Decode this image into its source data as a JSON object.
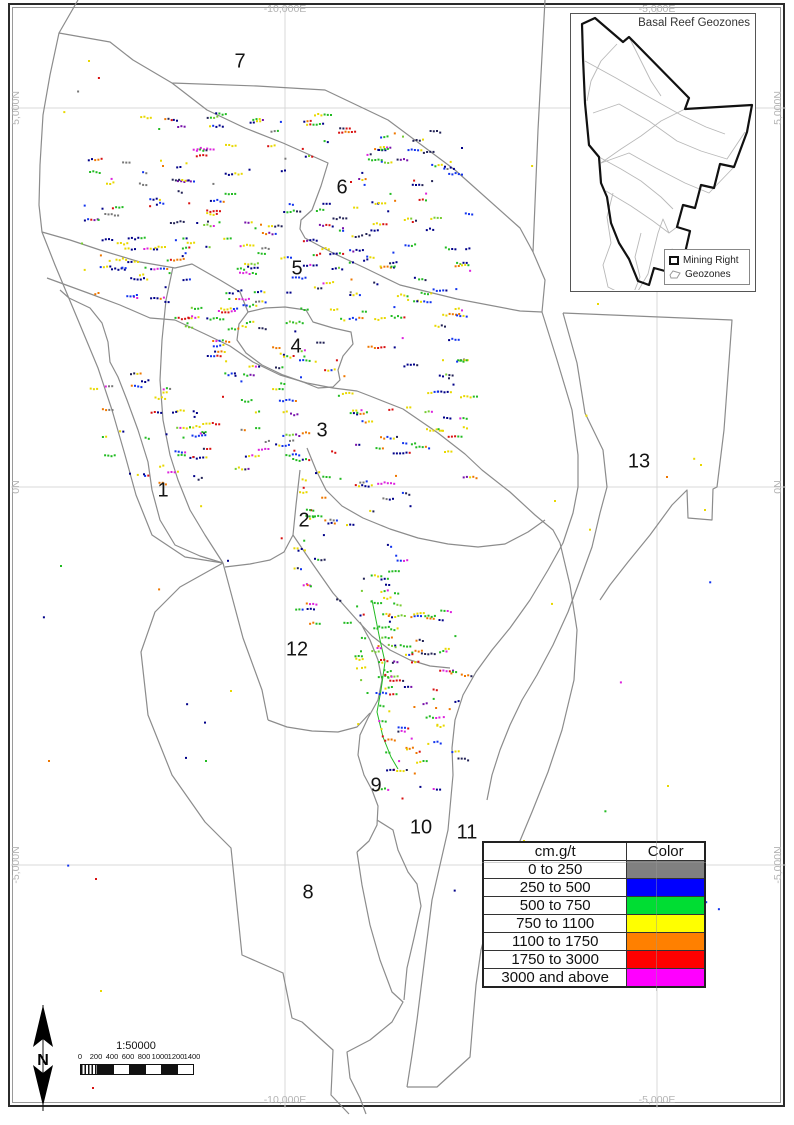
{
  "map": {
    "background": "#ffffff",
    "gridline_color": "#d9d9d9",
    "boundary_color": "#8c8c8c",
    "grid_labels": {
      "top": [
        {
          "text": "-10,000E",
          "x": 285
        },
        {
          "text": "-5,000E",
          "x": 657
        }
      ],
      "bottom": [
        {
          "text": "-10,000E",
          "x": 285
        },
        {
          "text": "-5,000E",
          "x": 657
        }
      ],
      "left": [
        {
          "text": "5,000N",
          "y": 108
        },
        {
          "text": "0N",
          "y": 487
        },
        {
          "text": "-5,000N",
          "y": 865
        }
      ],
      "right": [
        {
          "text": "5,000N",
          "y": 108
        },
        {
          "text": "0N",
          "y": 487
        },
        {
          "text": "-5,000N",
          "y": 865
        }
      ]
    },
    "grid_x": [
      285,
      657
    ],
    "grid_y": [
      108,
      487,
      865
    ],
    "zone_labels": [
      {
        "n": "1",
        "x": 163,
        "y": 491
      },
      {
        "n": "2",
        "x": 304,
        "y": 521
      },
      {
        "n": "3",
        "x": 322,
        "y": 431
      },
      {
        "n": "4",
        "x": 296,
        "y": 347
      },
      {
        "n": "5",
        "x": 297,
        "y": 269
      },
      {
        "n": "6",
        "x": 342,
        "y": 188
      },
      {
        "n": "7",
        "x": 240,
        "y": 62
      },
      {
        "n": "8",
        "x": 308,
        "y": 893
      },
      {
        "n": "9",
        "x": 376,
        "y": 786
      },
      {
        "n": "10",
        "x": 421,
        "y": 828
      },
      {
        "n": "11",
        "x": 467,
        "y": 833
      },
      {
        "n": "12",
        "x": 297,
        "y": 650
      },
      {
        "n": "13",
        "x": 639,
        "y": 462
      }
    ],
    "boundaries": [
      [
        78,
        0,
        59,
        33,
        50,
        75,
        43,
        115,
        40,
        165,
        39,
        205,
        42,
        232,
        55,
        265,
        78,
        320,
        98,
        368,
        112,
        410,
        125,
        455,
        136,
        495,
        152,
        535,
        185,
        557,
        223,
        563
      ],
      [
        223,
        563,
        180,
        587,
        155,
        612,
        141,
        652,
        148,
        715,
        172,
        775,
        205,
        822,
        231,
        848,
        242,
        955,
        283,
        973,
        292,
        1018,
        302,
        1022,
        333,
        1050,
        331,
        1095,
        349,
        1114
      ],
      [
        59,
        33,
        110,
        42,
        133,
        60,
        172,
        83,
        257,
        86,
        325,
        90,
        388,
        120,
        455,
        170,
        520,
        228,
        533,
        252
      ],
      [
        545,
        0,
        538,
        130,
        533,
        252
      ],
      [
        533,
        252,
        545,
        280,
        542,
        312
      ],
      [
        172,
        83,
        207,
        110,
        245,
        128,
        283,
        143,
        328,
        163,
        321,
        186,
        312,
        210,
        301,
        220,
        300,
        229,
        305,
        238,
        333,
        253,
        365,
        268,
        400,
        285,
        457,
        299,
        520,
        311,
        542,
        312
      ],
      [
        42,
        232,
        70,
        240,
        100,
        250,
        140,
        262,
        175,
        268,
        192,
        264,
        220,
        280,
        240,
        292,
        248,
        312
      ],
      [
        60,
        290,
        69,
        298,
        90,
        308,
        102,
        323,
        108,
        342,
        110,
        362,
        118,
        377,
        127,
        400,
        138,
        430,
        148,
        462,
        152,
        490,
        160,
        520,
        175,
        545,
        200,
        556,
        223,
        563
      ],
      [
        173,
        267,
        166,
        300,
        162,
        340,
        160,
        380,
        163,
        420,
        170,
        455,
        178,
        480,
        190,
        510,
        205,
        535,
        223,
        563
      ],
      [
        248,
        312,
        265,
        308,
        285,
        307,
        306,
        310,
        313,
        322,
        333,
        328,
        351,
        332,
        353,
        344,
        343,
        356,
        338,
        370,
        340,
        380,
        333,
        387,
        318,
        388,
        303,
        382,
        283,
        375,
        262,
        365,
        246,
        353,
        237,
        340,
        239,
        324,
        248,
        312
      ],
      [
        47,
        278,
        88,
        293,
        120,
        305,
        150,
        318,
        175,
        320
      ],
      [
        175,
        320,
        205,
        334,
        230,
        346,
        253,
        362,
        280,
        375,
        307,
        383,
        333,
        388,
        357,
        391,
        370,
        396,
        403,
        409,
        438,
        433,
        465,
        454,
        482,
        470,
        510,
        492,
        535,
        515,
        553,
        530,
        560,
        543
      ],
      [
        307,
        448,
        316,
        470,
        326,
        490,
        342,
        506,
        363,
        518,
        390,
        529,
        418,
        538,
        448,
        544,
        478,
        547,
        505,
        544,
        528,
        532,
        545,
        520
      ],
      [
        300,
        470,
        296,
        505,
        293,
        535
      ],
      [
        225,
        567,
        250,
        564,
        270,
        560,
        284,
        552,
        293,
        535,
        312,
        563,
        333,
        593,
        357,
        620,
        372,
        636,
        390,
        650,
        410,
        660,
        430,
        666,
        450,
        668
      ],
      [
        542,
        312,
        557,
        360,
        572,
        410,
        578,
        455,
        578,
        487,
        573,
        513,
        563,
        543,
        548,
        570,
        530,
        600,
        510,
        628,
        492,
        650,
        476,
        672,
        463,
        695,
        455,
        720,
        452,
        748,
        453,
        775,
        448,
        830,
        440,
        865,
        432,
        900,
        427,
        940,
        422,
        980,
        417,
        1020,
        412,
        1055,
        407,
        1087
      ],
      [
        563,
        313,
        577,
        363,
        585,
        413,
        603,
        450,
        607,
        487,
        600,
        513,
        592,
        547,
        580,
        580,
        568,
        612,
        553,
        645,
        537,
        675,
        522,
        700,
        510,
        725,
        500,
        750,
        492,
        775,
        487,
        800
      ],
      [
        563,
        313,
        732,
        320,
        724,
        430,
        717,
        487,
        713,
        489,
        712,
        520,
        688,
        518,
        687,
        490,
        672,
        505,
        650,
        535,
        628,
        562,
        610,
        585,
        600,
        600
      ],
      [
        560,
        543,
        570,
        585,
        577,
        630,
        574,
        680,
        562,
        730,
        548,
        772,
        532,
        812,
        517,
        848,
        502,
        882,
        490,
        915,
        481,
        950,
        476,
        985,
        473,
        1020,
        470,
        1057,
        437,
        1087,
        407,
        1087
      ],
      [
        223,
        563,
        243,
        638,
        262,
        690,
        268,
        720
      ],
      [
        268,
        720,
        287,
        727,
        312,
        731,
        338,
        732,
        357,
        727,
        370,
        713
      ],
      [
        360,
        622,
        370,
        640,
        378,
        660,
        382,
        680,
        378,
        700,
        368,
        718,
        360,
        735,
        358,
        755,
        364,
        775,
        372,
        790,
        378,
        806,
        377,
        825,
        369,
        841,
        357,
        852
      ],
      [
        357,
        852,
        362,
        885,
        370,
        925,
        380,
        960,
        392,
        992,
        403,
        1002,
        392,
        1022,
        370,
        1040,
        347,
        1052,
        350,
        1078,
        360,
        1098,
        366,
        1114
      ],
      [
        377,
        820,
        393,
        830,
        398,
        850,
        408,
        872,
        417,
        884,
        421,
        906,
        414,
        938,
        407,
        968,
        404,
        1000
      ]
    ],
    "green_streak": [
      372,
      600,
      380,
      640,
      385,
      662,
      381,
      690,
      377,
      712,
      383,
      737,
      391,
      757,
      398,
      769
    ],
    "palette": {
      "navy": "#000088",
      "blue": "#1133ee",
      "green": "#22bb22",
      "lime": "#77cc33",
      "yellow": "#e8d800",
      "orange": "#ee7700",
      "red": "#d81111",
      "magenta": "#dd22dd",
      "purple": "#7711aa",
      "dark": "#222255",
      "gray": "#777777"
    },
    "clusters": [
      {
        "name": "northwest-field",
        "seed": 101,
        "x": 80,
        "y": 113,
        "w": 262,
        "h": 190,
        "runs": 125,
        "maxRun": 6,
        "weights": {
          "navy": 20,
          "blue": 12,
          "green": 16,
          "lime": 4,
          "yellow": 15,
          "orange": 7,
          "red": 8,
          "magenta": 5,
          "purple": 4,
          "dark": 6,
          "gray": 3
        }
      },
      {
        "name": "northeast-field",
        "seed": 202,
        "x": 346,
        "y": 126,
        "w": 122,
        "h": 192,
        "runs": 72,
        "maxRun": 5,
        "weights": {
          "navy": 26,
          "blue": 14,
          "green": 12,
          "lime": 3,
          "yellow": 12,
          "orange": 5,
          "red": 6,
          "magenta": 4,
          "purple": 3,
          "dark": 7,
          "gray": 2
        }
      },
      {
        "name": "central-field",
        "seed": 303,
        "x": 172,
        "y": 298,
        "w": 292,
        "h": 190,
        "runs": 125,
        "maxRun": 6,
        "weights": {
          "navy": 12,
          "blue": 8,
          "green": 16,
          "lime": 5,
          "yellow": 18,
          "orange": 9,
          "red": 9,
          "magenta": 6,
          "purple": 4,
          "dark": 5,
          "gray": 3
        }
      },
      {
        "name": "west-low-field",
        "seed": 404,
        "x": 88,
        "y": 372,
        "w": 116,
        "h": 112,
        "runs": 30,
        "maxRun": 4,
        "weights": {
          "navy": 14,
          "blue": 8,
          "green": 14,
          "yellow": 12,
          "orange": 5,
          "red": 5,
          "magenta": 3,
          "dark": 5,
          "gray": 3
        }
      },
      {
        "name": "zone2-strip",
        "seed": 505,
        "x": 290,
        "y": 490,
        "w": 126,
        "h": 136,
        "runs": 40,
        "maxRun": 4,
        "weights": {
          "navy": 12,
          "blue": 7,
          "green": 14,
          "yellow": 14,
          "orange": 7,
          "red": 6,
          "magenta": 4,
          "dark": 5,
          "gray": 3
        }
      },
      {
        "name": "south-green-strip",
        "seed": 606,
        "x": 352,
        "y": 552,
        "w": 48,
        "h": 160,
        "runs": 32,
        "maxRun": 4,
        "weights": {
          "green": 30,
          "lime": 8,
          "yellow": 6,
          "navy": 5,
          "blue": 3,
          "orange": 3,
          "red": 2,
          "magenta": 2,
          "dark": 3
        }
      },
      {
        "name": "south-mixed-strip",
        "seed": 707,
        "x": 374,
        "y": 608,
        "w": 88,
        "h": 190,
        "runs": 62,
        "maxRun": 5,
        "weights": {
          "orange": 16,
          "red": 14,
          "yellow": 14,
          "magenta": 9,
          "green": 10,
          "lime": 4,
          "navy": 8,
          "blue": 5,
          "purple": 5,
          "dark": 5
        }
      },
      {
        "name": "outliers",
        "seed": 808,
        "x": 42,
        "y": 55,
        "w": 690,
        "h": 960,
        "runs": 55,
        "maxRun": 1,
        "weights": {
          "navy": 8,
          "blue": 5,
          "green": 10,
          "yellow": 12,
          "orange": 6,
          "red": 5,
          "magenta": 3,
          "gray": 3
        }
      }
    ],
    "extra_points": [
      [
        88,
        60,
        "yellow"
      ],
      [
        92,
        1087,
        "red"
      ],
      [
        700,
        464,
        "yellow"
      ],
      [
        704,
        509,
        "yellow"
      ],
      [
        666,
        476,
        "orange"
      ],
      [
        597,
        303,
        "yellow"
      ],
      [
        461,
        147,
        "navy"
      ],
      [
        523,
        840,
        "yellow"
      ],
      [
        60,
        565,
        "green"
      ],
      [
        48,
        760,
        "orange"
      ],
      [
        100,
        990,
        "yellow"
      ],
      [
        205,
        760,
        "green"
      ],
      [
        230,
        690,
        "yellow"
      ]
    ]
  },
  "inset": {
    "title": "Basal Reef Geozones",
    "legend": [
      {
        "label": "Mining Right"
      },
      {
        "label": "Geozones"
      }
    ],
    "mining_right": [
      581,
      23,
      594,
      17,
      622,
      41,
      628,
      36,
      688,
      97,
      684,
      108,
      751,
      104,
      746,
      131,
      733,
      166,
      719,
      163,
      713,
      187,
      700,
      184,
      694,
      207,
      682,
      204,
      676,
      226,
      689,
      230,
      684,
      252,
      671,
      249,
      664,
      270,
      653,
      267,
      648,
      284,
      637,
      280,
      628,
      258,
      618,
      242,
      610,
      222,
      606,
      196,
      600,
      182,
      598,
      156,
      588,
      144,
      584,
      102,
      582,
      57,
      581,
      23
    ],
    "geozone_lines": [
      [
        584,
        60,
        615,
        77,
        648,
        96,
        680,
        114,
        705,
        126,
        724,
        133
      ],
      [
        592,
        112,
        618,
        103,
        648,
        120,
        676,
        140,
        700,
        150,
        726,
        158,
        744,
        131
      ],
      [
        600,
        162,
        628,
        152,
        655,
        167,
        684,
        182,
        708,
        192,
        733,
        166
      ],
      [
        605,
        190,
        630,
        205,
        652,
        220,
        668,
        232,
        676,
        226
      ],
      [
        612,
        192,
        606,
        216,
        610,
        242,
        602,
        264,
        607,
        286,
        621,
        293,
        637,
        290,
        647,
        273,
        652,
        252,
        657,
        232,
        662,
        218,
        668,
        232
      ],
      [
        640,
        232,
        634,
        256,
        639,
        276,
        633,
        291
      ],
      [
        598,
        156,
        620,
        168,
        640,
        180,
        660,
        196,
        672,
        208
      ],
      [
        616,
        43,
        600,
        60,
        590,
        80,
        586,
        100
      ],
      [
        628,
        36,
        640,
        60,
        650,
        80,
        660,
        95
      ],
      [
        684,
        108,
        660,
        120,
        640,
        135,
        620,
        148,
        600,
        162
      ]
    ]
  },
  "legend_table": {
    "headers": [
      "cm.g/t",
      "Color"
    ],
    "rows": [
      {
        "range": "0 to 250",
        "color": "#808080"
      },
      {
        "range": "250 to 500",
        "color": "#0000ff"
      },
      {
        "range": "500 to 750",
        "color": "#00dd33"
      },
      {
        "range": "750 to 1100",
        "color": "#ffff00"
      },
      {
        "range": "1100 to 1750",
        "color": "#ff8000"
      },
      {
        "range": "1750 to 3000",
        "color": "#ff0000"
      },
      {
        "range": "3000 and above",
        "color": "#ff00ff"
      }
    ]
  },
  "scale_bar": {
    "ratio": "1:50000",
    "ticks": [
      "0",
      "200",
      "400",
      "600",
      "800",
      "1000",
      "1200",
      "1400"
    ]
  },
  "north_arrow": {
    "label": "N"
  }
}
